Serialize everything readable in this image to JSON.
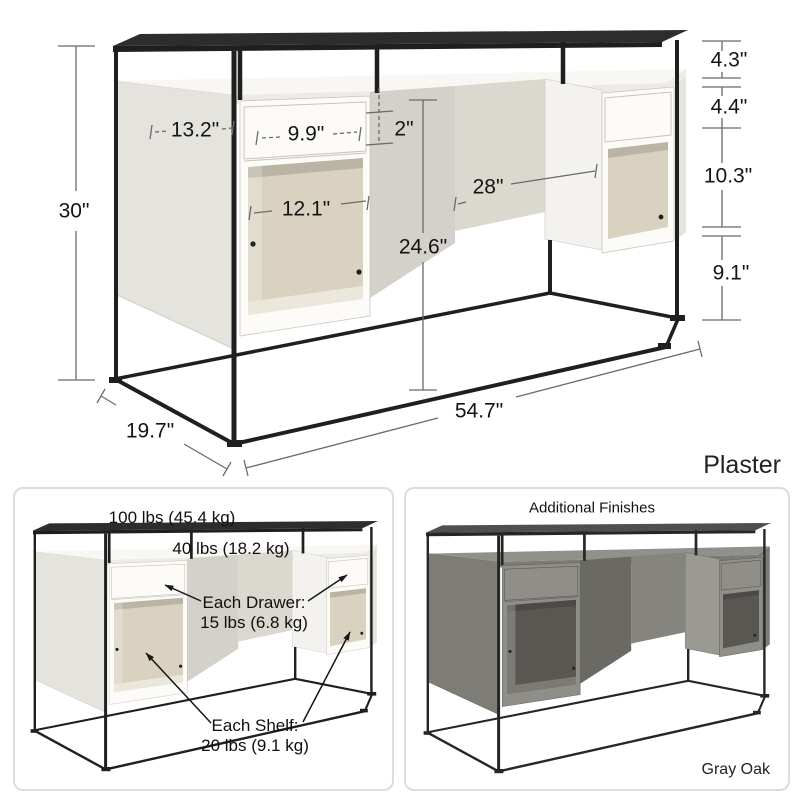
{
  "product_diagram": {
    "finish_label": "Plaster",
    "dimensions": {
      "overall_height": "30\"",
      "side_depth": "13.2\"",
      "drawer_width": "9.9\"",
      "top_gap": "2\"",
      "knee_space_width": "28\"",
      "shelf_width": "12.1\"",
      "knee_space_height": "24.6\"",
      "shelf_riser_height": "4.3\"",
      "drawer_height": "4.4\"",
      "cubby_height": "10.3\"",
      "base_clearance": "9.1\"",
      "overall_width": "54.7\"",
      "overall_depth": "19.7\""
    }
  },
  "capacity_panel": {
    "top_shelf_capacity": "100 lbs (45.4 kg)",
    "desktop_capacity": "40 lbs (18.2 kg)",
    "drawer_label": "Each Drawer:",
    "drawer_capacity": "15 lbs (6.8 kg)",
    "shelf_label": "Each Shelf:",
    "shelf_capacity": "20 lbs (9.1 kg)"
  },
  "finishes_panel": {
    "title": "Additional Finishes",
    "finish_label": "Gray Oak"
  },
  "colors": {
    "frame_black": "#1e1e1e",
    "plaster_finish": "#e9e7e1",
    "gray_oak_finish": "#807f79",
    "dimension_line": "#6a6a6a",
    "panel_border": "#dcdcdc"
  }
}
